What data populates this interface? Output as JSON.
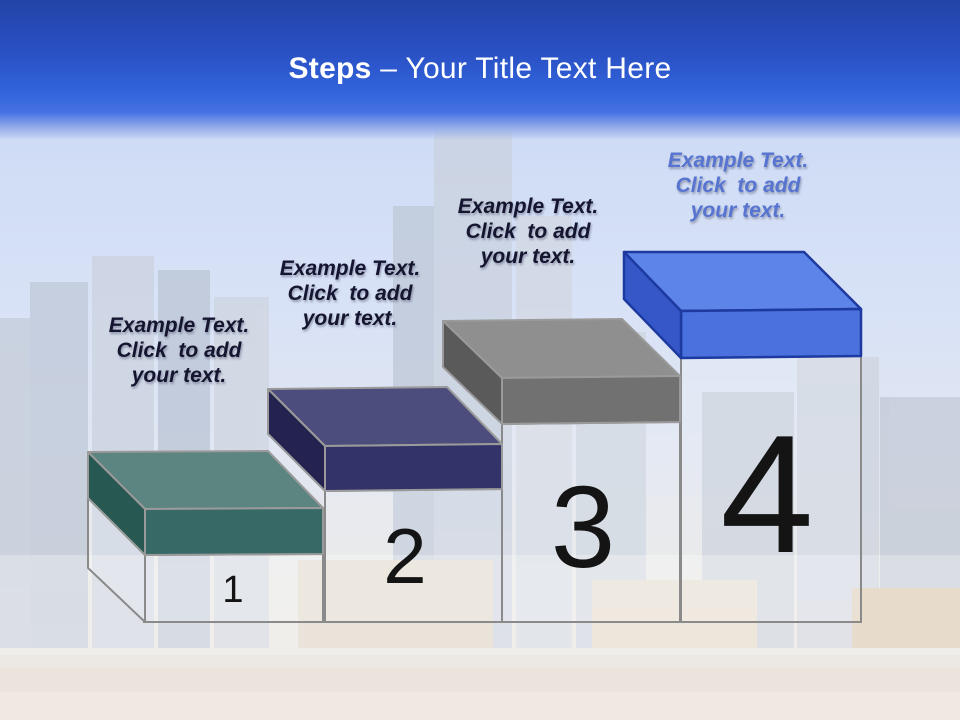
{
  "title": {
    "bold": "Steps",
    "rest": " – Your Title Text Here"
  },
  "number_color": "#141414",
  "structure_color": "#8a8a8a",
  "column_fill": "rgba(255,255,255,0.15)",
  "header": {
    "gradient_top": "#2343a8",
    "gradient_mid": "#3263da",
    "gradient_fade": "#c8d7f3",
    "title_color": "#ffffff"
  },
  "steps": [
    {
      "number": "1",
      "label": "Example Text.\nClick  to add\nyour text.",
      "label_color": "#15152f",
      "colors": {
        "top": "#5c8480",
        "front": "#376a66",
        "side": "#275852",
        "outline": "#9a9a9a"
      }
    },
    {
      "number": "2",
      "label": "Example Text.\nClick  to add\nyour text.",
      "label_color": "#15152f",
      "colors": {
        "top": "#4d4d7d",
        "front": "#343369",
        "side": "#242350",
        "outline": "#9a9a9a"
      }
    },
    {
      "number": "3",
      "label": "Example Text.\nClick  to add\nyour text.",
      "label_color": "#15152f",
      "colors": {
        "top": "#8f8f8f",
        "front": "#717171",
        "side": "#5a5a5a",
        "outline": "#9a9a9a"
      }
    },
    {
      "number": "4",
      "label": "Example Text.\nClick  to add\nyour text.",
      "label_color": "#5674d0",
      "colors": {
        "top": "#5d84e8",
        "front": "#4a71de",
        "side": "#3557c8",
        "outline": "#1d3aa0"
      }
    }
  ]
}
